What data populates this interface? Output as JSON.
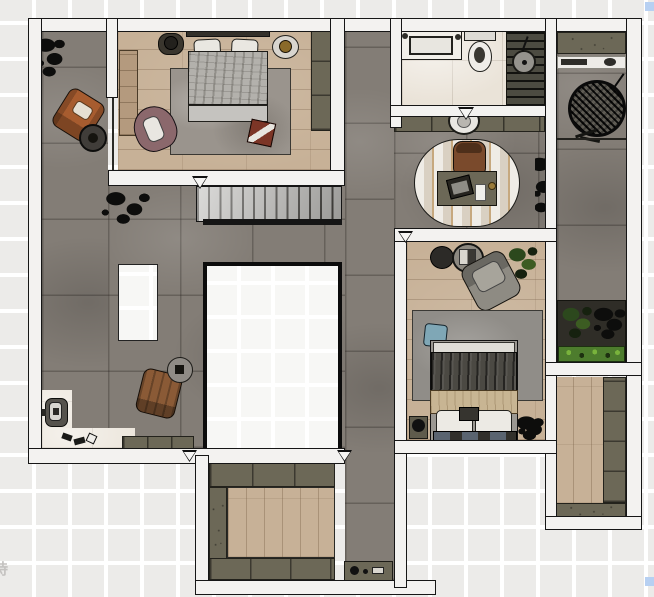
{
  "canvas": {
    "width_px": 654,
    "height_px": 597,
    "background_pattern": "checkerboard-grid"
  },
  "watermark": {
    "text": "持",
    "color": "#c4c2c0"
  },
  "selection": {
    "handle_color": "#b7d0f2",
    "handles": [
      "top-right",
      "bottom-right"
    ]
  },
  "palette": {
    "wall": "#f3f2f0",
    "wall_outline": "#161616",
    "stone_floor": "#837d76",
    "wood_floor": "#c7b197",
    "marble_floor": "#eae3d8",
    "cabinet_olive": "#6c6857",
    "void_border": "#0c0c0c",
    "stair_tread": "#bdbcb9",
    "accent_orange": "#e0791f",
    "plant_green": "#4d7c2d",
    "duvet_gray": "#b3b1ac",
    "duvet_dark": "#4b4943",
    "leather_orange_chair": "#a75c2f",
    "mauve_chair": "#8b686c",
    "brown_chair": "#8a5a36",
    "pillow_blue": "#7fa7b6"
  },
  "scene": {
    "type": "apartment-floor-plan-top-down-render",
    "rooms": [
      {
        "name": "master-bedroom",
        "furniture": [
          "double-bed",
          "pillows",
          "nightstand-left",
          "nightstand-right",
          "area-rug",
          "mauve-accent-chair",
          "red-tray-table",
          "wardrobe",
          "wood-panel"
        ]
      },
      {
        "name": "left-terrace",
        "furniture": [
          "potted-plant",
          "orange-leather-armchair",
          "round-side-table"
        ]
      },
      {
        "name": "living-hall",
        "furniture": [
          "staircase",
          "floor-plant",
          "white-island",
          "central-floor-void",
          "brown-lounge-chair",
          "round-side-table",
          "sideboard",
          "entry-fixture",
          "shoes",
          "orange-wall-shelf"
        ]
      },
      {
        "name": "bathroom",
        "furniture": [
          "vanity-sink",
          "toilet",
          "walk-in-shower",
          "shower-head"
        ]
      },
      {
        "name": "hallway-vanity",
        "furniture": [
          "cabinet-row",
          "round-washbasin"
        ]
      },
      {
        "name": "study-nook",
        "furniture": [
          "oval-rug",
          "desk",
          "laptop",
          "desk-chair",
          "plant-strip"
        ]
      },
      {
        "name": "bedroom-2",
        "furniture": [
          "double-bed",
          "blue-pillow",
          "area-rug",
          "gray-lounge-chair",
          "round-side-tables",
          "potted-plant",
          "nightstand",
          "corner-plant"
        ]
      },
      {
        "name": "walk-in-closet",
        "furniture": [
          "wardrobe-cabinets",
          "wood-floor-inlay"
        ]
      },
      {
        "name": "rear-corridor",
        "furniture": [
          "console-shelf"
        ]
      },
      {
        "name": "right-balcony",
        "furniture": [
          "planter-shelf",
          "display-shelf",
          "hanging-egg-chair"
        ]
      },
      {
        "name": "planter-box",
        "furniture": [
          "shrubs",
          "ground-cover-plants"
        ]
      },
      {
        "name": "storage-room",
        "furniture": [
          "cabinets",
          "wood-floor"
        ]
      }
    ]
  }
}
